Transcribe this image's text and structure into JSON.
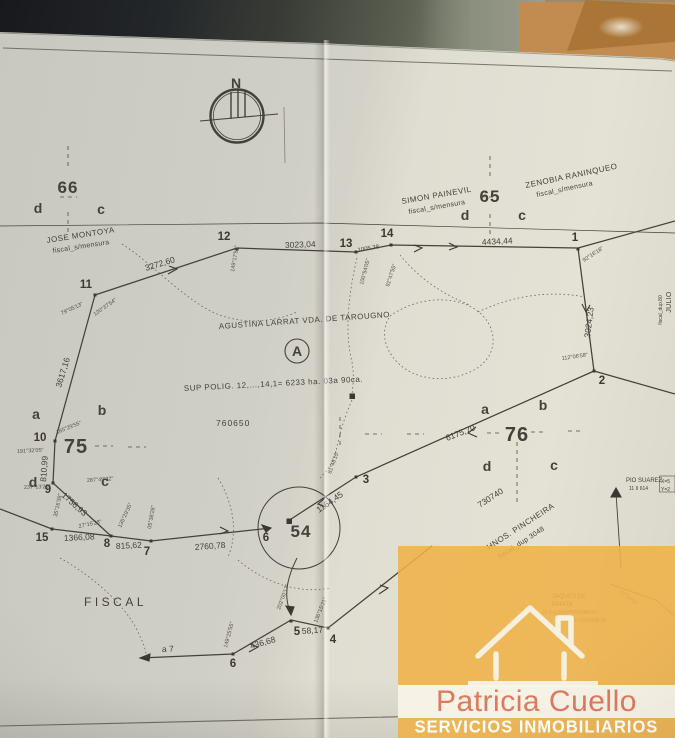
{
  "photo": {
    "paper_color": "#d3d1c8",
    "envelope_color": "#c28c50",
    "background_dark": "#17191c",
    "ink_color": "#45413a"
  },
  "plan": {
    "compass_label": "N",
    "parcels": {
      "nw": "66",
      "ne": "65",
      "sw": "75",
      "se": "76",
      "station_circle": "54",
      "reference": "A"
    },
    "quadrants": {
      "p66": {
        "d": "d",
        "c": "c"
      },
      "p65": {
        "d": "d",
        "c": "c"
      },
      "p75": {
        "a": "a",
        "b": "b",
        "d": "d",
        "c": "c"
      },
      "p76": {
        "a": "a",
        "b": "b",
        "d": "d",
        "c": "c"
      }
    },
    "owners": [
      {
        "name": "JOSE  MONTOYA",
        "note": "fiscal_s/mensura"
      },
      {
        "name": "SIMON  PAINEVIL",
        "note": "fiscal_s/mensura"
      },
      {
        "name": "ZENOBIA  RANINQUEO",
        "note": "fiscal_s/mensura"
      },
      {
        "name": "AGUSTINA  LARRAT   VDA.  DE  TAROUGNO",
        "note": ""
      },
      {
        "name": "HNOS.  PINCHEIRA",
        "note": "fiscal_dup 3048"
      },
      {
        "name": "PIO SUAREZ",
        "note": "11 II 614"
      },
      {
        "name": "JULIO",
        "note": "fiscal_dup.80"
      },
      {
        "name": "JAQUES DE",
        "name2": "PANITII",
        "coord_x": "21 II 615(X=5434080.39",
        "coord_y": "(Y=1510938.35"
      }
    ],
    "area_text": "SUP POLIG. 12,...,14,1= 6233 ha. 03a 90ca.",
    "fiscal_label": "FISCAL",
    "sheet_refs": {
      "left": "760650",
      "right": "730740"
    },
    "coord_box": {
      "x": "X=5",
      "y": "Y=2"
    },
    "direction_note": "a 7",
    "vertices": {
      "v1": "1",
      "v2": "2",
      "v3": "3",
      "v4": "4",
      "v5": "5",
      "v6": "6",
      "v6b": "6",
      "v7": "7",
      "v8": "8",
      "v9": "9",
      "v10": "10",
      "v11": "11",
      "v12": "12",
      "v13": "13",
      "v14": "14",
      "v15": "15"
    },
    "distances": {
      "seg_11_12": "3272,60",
      "seg_12_13": "3023,04",
      "seg_13_14": "1005,38",
      "seg_14_1": "4434,44",
      "seg_1_2": "3024,23",
      "seg_11_10": "3617,16",
      "seg_10_9": "810,99",
      "seg_9_8": "1756,93",
      "seg_15_8": "1366,08",
      "seg_8_7": "815,62",
      "seg_7_6": "2760,78",
      "seg_2_3": "6175,70",
      "seg_3_54": "1164,45",
      "seg_6_5": "436,68",
      "seg_5_4": "58,17"
    },
    "angles": {
      "at_10_a": "191°32'05\"",
      "at_10_b": "165°29'55\"",
      "at_9_a": "237°13'25\"",
      "at_9_b": "287°49'32\"",
      "at_8_a": "35°16'38\"",
      "at_8_b": "27°15'28\"",
      "at_7_a": "135°29'35\"",
      "at_7_b": "05°38'28\"",
      "at_11_a": "79°05'13\"",
      "at_11_b": "120°37'54\"",
      "at_12": "149°17'55\"",
      "at_13": "100°54'05\"",
      "at_14": "92°47'55\"",
      "at_1": "92°16'18\"",
      "at_2": "112°06'58\"",
      "at_3": "81°48'15\"",
      "at_6": "149°25'55\"",
      "at_54": "202°00'17\"",
      "at_5": "136°15'21\"",
      "at_jaques": "67°34'02\""
    }
  },
  "watermark": {
    "brand": "Patricia Cuello",
    "tagline": "SERVICIOS INMOBILIARIOS",
    "band_color": "#efb54b",
    "brand_color": "#dd7a5e",
    "tagline_color": "#ffffff"
  }
}
